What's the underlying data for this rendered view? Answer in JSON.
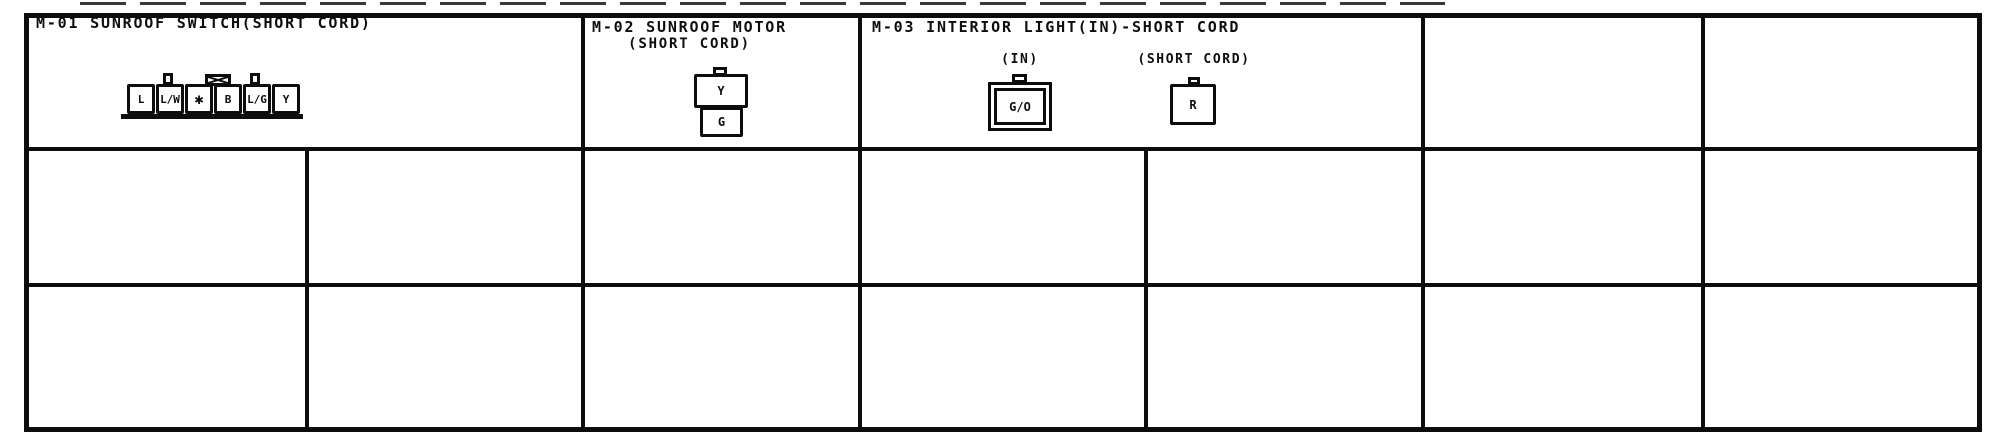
{
  "colors": {
    "ink": "#0d0d0d",
    "paper": "#ffffff"
  },
  "m01": {
    "title": "M-01 SUNROOF SWITCH(SHORT CORD)",
    "pins": [
      "L",
      "L/W",
      "✱",
      "B",
      "L/G",
      "Y"
    ]
  },
  "m02": {
    "title_line1": "M-02 SUNROOF MOTOR",
    "title_line2": "(SHORT CORD)",
    "pin_top": "Y",
    "pin_bottom": "G"
  },
  "m03": {
    "title": "M-03 INTERIOR LIGHT(IN)-SHORT CORD",
    "sub1_label": "(IN)",
    "sub1_pin": "G/O",
    "sub2_label": "(SHORT CORD)",
    "sub2_pin": "R"
  }
}
